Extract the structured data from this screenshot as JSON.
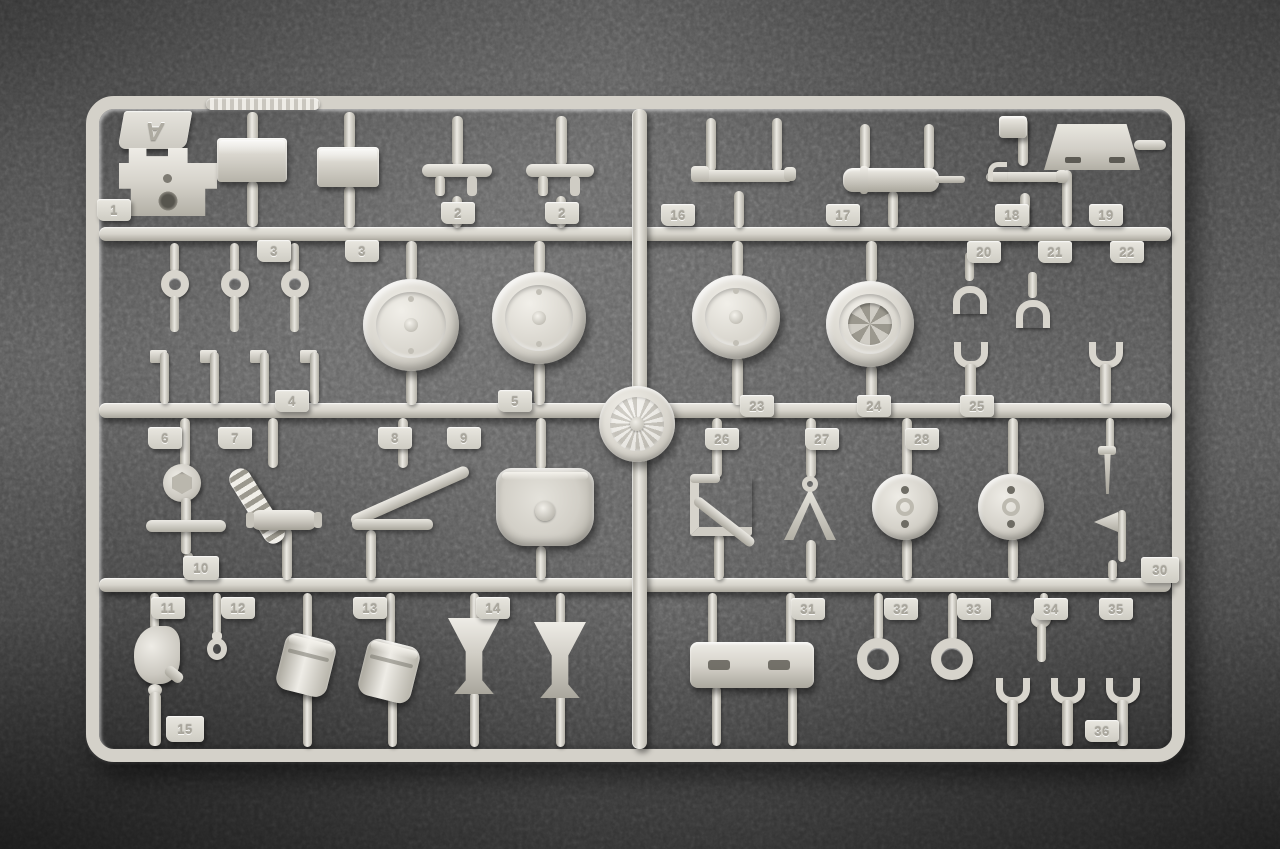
{
  "sprue": {
    "letter": "A",
    "plastic_color": "#d7d4cc",
    "plastic_highlight": "#efede7",
    "plastic_shadow": "#a8a59b"
  },
  "background": {
    "carpet_color": "#5b5b5b",
    "vignette_color": "#2e2e2e"
  },
  "logo": {
    "icon": "embossed-emblem-icon"
  },
  "part_numbers_visible": [
    "1",
    "2",
    "3",
    "4",
    "5",
    "6",
    "7",
    "8",
    "9",
    "10",
    "11",
    "12",
    "13",
    "14",
    "15",
    "16",
    "17",
    "18",
    "19",
    "20",
    "21",
    "22",
    "23",
    "24",
    "25",
    "26",
    "27",
    "28",
    "30",
    "31",
    "32",
    "33",
    "34",
    "35",
    "36"
  ],
  "parts": [
    {
      "t": "pin",
      "x": 247,
      "y": 112,
      "w": 11,
      "h": 30
    },
    {
      "t": "pin",
      "x": 247,
      "y": 181,
      "w": 11,
      "h": 46
    },
    {
      "t": "pin",
      "x": 344,
      "y": 112,
      "w": 11,
      "h": 38
    },
    {
      "t": "pin",
      "x": 344,
      "y": 186,
      "w": 11,
      "h": 42
    },
    {
      "t": "pin",
      "x": 452,
      "y": 116,
      "w": 11,
      "h": 50
    },
    {
      "t": "pin",
      "x": 556,
      "y": 116,
      "w": 11,
      "h": 50
    },
    {
      "t": "pin",
      "x": 452,
      "y": 196,
      "w": 10,
      "h": 32
    },
    {
      "t": "pin",
      "x": 556,
      "y": 196,
      "w": 10,
      "h": 32
    },
    {
      "t": "pin",
      "x": 706,
      "y": 118,
      "w": 10,
      "h": 54
    },
    {
      "t": "pin",
      "x": 772,
      "y": 118,
      "w": 10,
      "h": 54
    },
    {
      "t": "pin",
      "x": 734,
      "y": 191,
      "w": 10,
      "h": 37
    },
    {
      "t": "pin",
      "x": 860,
      "y": 124,
      "w": 10,
      "h": 46
    },
    {
      "t": "pin",
      "x": 924,
      "y": 124,
      "w": 10,
      "h": 46
    },
    {
      "t": "pin",
      "x": 888,
      "y": 191,
      "w": 10,
      "h": 37
    },
    {
      "t": "pin",
      "x": 1018,
      "y": 118,
      "w": 10,
      "h": 48
    },
    {
      "t": "pin",
      "x": 1020,
      "y": 193,
      "w": 10,
      "h": 35
    },
    {
      "t": "pin",
      "x": 1062,
      "y": 170,
      "w": 10,
      "h": 57
    },
    {
      "t": "pinh",
      "x": 1134,
      "y": 140,
      "w": 32,
      "h": 10
    },
    {
      "t": "pin",
      "x": 170,
      "y": 243,
      "w": 9,
      "h": 30
    },
    {
      "t": "pin",
      "x": 230,
      "y": 243,
      "w": 9,
      "h": 30
    },
    {
      "t": "pin",
      "x": 290,
      "y": 243,
      "w": 9,
      "h": 30
    },
    {
      "t": "pin",
      "x": 406,
      "y": 241,
      "w": 11,
      "h": 40
    },
    {
      "t": "pin",
      "x": 406,
      "y": 369,
      "w": 11,
      "h": 36
    },
    {
      "t": "pin",
      "x": 534,
      "y": 241,
      "w": 11,
      "h": 33
    },
    {
      "t": "pin",
      "x": 534,
      "y": 362,
      "w": 11,
      "h": 43
    },
    {
      "t": "pin",
      "x": 732,
      "y": 241,
      "w": 11,
      "h": 36
    },
    {
      "t": "pin",
      "x": 732,
      "y": 357,
      "w": 11,
      "h": 48
    },
    {
      "t": "pin",
      "x": 866,
      "y": 241,
      "w": 11,
      "h": 42
    },
    {
      "t": "pin",
      "x": 866,
      "y": 365,
      "w": 11,
      "h": 40
    },
    {
      "t": "pin",
      "x": 968,
      "y": 241,
      "w": 9,
      "h": 14
    },
    {
      "t": "pin",
      "x": 1106,
      "y": 418,
      "w": 8,
      "h": 32
    },
    {
      "t": "pin",
      "x": 180,
      "y": 418,
      "w": 10,
      "h": 50
    },
    {
      "t": "pin",
      "x": 184,
      "y": 552,
      "w": 9,
      "h": 28
    },
    {
      "t": "pin",
      "x": 268,
      "y": 418,
      "w": 10,
      "h": 50
    },
    {
      "t": "pin",
      "x": 282,
      "y": 528,
      "w": 10,
      "h": 52
    },
    {
      "t": "pin",
      "x": 398,
      "y": 418,
      "w": 10,
      "h": 50
    },
    {
      "t": "pin",
      "x": 366,
      "y": 530,
      "w": 10,
      "h": 50
    },
    {
      "t": "pin",
      "x": 536,
      "y": 418,
      "w": 10,
      "h": 52
    },
    {
      "t": "pin",
      "x": 536,
      "y": 546,
      "w": 10,
      "h": 34
    },
    {
      "t": "pin",
      "x": 712,
      "y": 418,
      "w": 10,
      "h": 60
    },
    {
      "t": "pin",
      "x": 714,
      "y": 534,
      "w": 10,
      "h": 46
    },
    {
      "t": "pin",
      "x": 806,
      "y": 418,
      "w": 10,
      "h": 60
    },
    {
      "t": "pin",
      "x": 806,
      "y": 540,
      "w": 10,
      "h": 40
    },
    {
      "t": "pin",
      "x": 902,
      "y": 418,
      "w": 10,
      "h": 58
    },
    {
      "t": "pin",
      "x": 902,
      "y": 538,
      "w": 10,
      "h": 42
    },
    {
      "t": "pin",
      "x": 1008,
      "y": 418,
      "w": 10,
      "h": 58
    },
    {
      "t": "pin",
      "x": 1008,
      "y": 538,
      "w": 10,
      "h": 42
    },
    {
      "t": "pin",
      "x": 1108,
      "y": 560,
      "w": 9,
      "h": 20
    },
    {
      "t": "pin",
      "x": 150,
      "y": 593,
      "w": 9,
      "h": 37
    },
    {
      "t": "pin",
      "x": 213,
      "y": 593,
      "w": 8,
      "h": 42
    },
    {
      "t": "pin",
      "x": 303,
      "y": 593,
      "w": 9,
      "h": 46
    },
    {
      "t": "pin",
      "x": 386,
      "y": 593,
      "w": 9,
      "h": 52
    },
    {
      "t": "pin",
      "x": 303,
      "y": 692,
      "w": 9,
      "h": 55
    },
    {
      "t": "pin",
      "x": 388,
      "y": 698,
      "w": 9,
      "h": 49
    },
    {
      "t": "pin",
      "x": 470,
      "y": 593,
      "w": 9,
      "h": 29
    },
    {
      "t": "pin",
      "x": 556,
      "y": 593,
      "w": 9,
      "h": 32
    },
    {
      "t": "pin",
      "x": 470,
      "y": 692,
      "w": 9,
      "h": 55
    },
    {
      "t": "pin",
      "x": 556,
      "y": 694,
      "w": 9,
      "h": 53
    },
    {
      "t": "pin",
      "x": 708,
      "y": 593,
      "w": 9,
      "h": 52
    },
    {
      "t": "pin",
      "x": 786,
      "y": 593,
      "w": 9,
      "h": 52
    },
    {
      "t": "pin",
      "x": 712,
      "y": 686,
      "w": 9,
      "h": 60
    },
    {
      "t": "pin",
      "x": 788,
      "y": 686,
      "w": 9,
      "h": 60
    },
    {
      "t": "pin",
      "x": 874,
      "y": 593,
      "w": 9,
      "h": 48
    },
    {
      "t": "pin",
      "x": 948,
      "y": 593,
      "w": 9,
      "h": 48
    },
    {
      "t": "pin",
      "x": 1040,
      "y": 593,
      "w": 8,
      "h": 21
    },
    {
      "t": "bracket",
      "x": 119,
      "y": 148,
      "w": 98,
      "h": 68,
      "n": "mount-bracket-part"
    },
    {
      "t": "boxp",
      "x": 217,
      "y": 138,
      "w": 70,
      "h": 44,
      "n": "stowage-box-part"
    },
    {
      "t": "boxp",
      "x": 317,
      "y": 147,
      "w": 62,
      "h": 40,
      "n": "stowage-box-part"
    },
    {
      "t": "tbar",
      "x": 422,
      "y": 164,
      "w": 70,
      "h": 36,
      "n": "t-rod-part"
    },
    {
      "t": "tbar",
      "x": 526,
      "y": 164,
      "w": 68,
      "h": 36,
      "n": "t-rod-part"
    },
    {
      "t": "rodf",
      "x": 695,
      "y": 170,
      "w": 98,
      "h": 12,
      "n": "linkage-rod-part"
    },
    {
      "t": "cylh",
      "x": 843,
      "y": 168,
      "w": 96,
      "h": 24,
      "n": "cylinder-rod-part"
    },
    {
      "t": "rodh",
      "x": 986,
      "y": 172,
      "w": 80,
      "h": 10,
      "n": "hooked-rod-part"
    },
    {
      "t": "blk",
      "x": 999,
      "y": 116,
      "w": 28,
      "h": 22,
      "n": "small-block-part"
    },
    {
      "t": "plate",
      "x": 1044,
      "y": 124,
      "w": 96,
      "h": 46,
      "n": "hull-plate-part"
    },
    {
      "t": "ringpin",
      "x": 156,
      "y": 270,
      "w": 38,
      "h": 62,
      "n": "ring-pin-part"
    },
    {
      "t": "ringpin",
      "x": 216,
      "y": 270,
      "w": 38,
      "h": 62,
      "n": "ring-pin-part"
    },
    {
      "t": "ringpin",
      "x": 276,
      "y": 270,
      "w": 38,
      "h": 62,
      "n": "ring-pin-part"
    },
    {
      "t": "wheel",
      "x": 363,
      "y": 279,
      "w": 96,
      "h": 92,
      "n": "road-wheel-part"
    },
    {
      "t": "wheel",
      "x": 492,
      "y": 272,
      "w": 94,
      "h": 92,
      "n": "road-wheel-part"
    },
    {
      "t": "pinflag",
      "x": 150,
      "y": 350,
      "w": 28,
      "h": 54,
      "n": "flanged-pin-part"
    },
    {
      "t": "pinflag",
      "x": 200,
      "y": 350,
      "w": 28,
      "h": 54,
      "n": "flanged-pin-part"
    },
    {
      "t": "pinflag",
      "x": 250,
      "y": 350,
      "w": 28,
      "h": 54,
      "n": "flanged-pin-part"
    },
    {
      "t": "pinflag",
      "x": 300,
      "y": 350,
      "w": 28,
      "h": 54,
      "n": "flanged-pin-part"
    },
    {
      "t": "wheel",
      "x": 692,
      "y": 275,
      "w": 88,
      "h": 84,
      "n": "road-wheel-part"
    },
    {
      "t": "wheelhub",
      "x": 826,
      "y": 281,
      "w": 88,
      "h": 86,
      "n": "hub-wheel-part"
    },
    {
      "t": "forky",
      "x": 945,
      "y": 252,
      "w": 50,
      "h": 62,
      "n": "clevis-fork-part"
    },
    {
      "t": "forky",
      "x": 1009,
      "y": 272,
      "w": 48,
      "h": 56,
      "n": "clevis-fork-part"
    },
    {
      "t": "forku",
      "x": 946,
      "y": 342,
      "w": 50,
      "h": 62,
      "n": "tow-fork-part"
    },
    {
      "t": "forku",
      "x": 1081,
      "y": 342,
      "w": 50,
      "h": 62,
      "n": "tow-fork-part"
    },
    {
      "t": "disc6",
      "x": 163,
      "y": 464,
      "w": 38,
      "h": 38,
      "n": "hex-disc-part"
    },
    {
      "t": "crossp",
      "x": 146,
      "y": 498,
      "w": 80,
      "h": 56,
      "n": "cross-lever-part"
    },
    {
      "t": "spring",
      "x": 246,
      "y": 464,
      "w": 22,
      "h": 84,
      "r": -32,
      "n": "coil-spring-part"
    },
    {
      "t": "cylsm",
      "x": 251,
      "y": 510,
      "w": 66,
      "h": 20,
      "n": "small-cylinder-part"
    },
    {
      "t": "trif",
      "x": 352,
      "y": 464,
      "w": 116,
      "h": 66,
      "n": "triangular-brace-part"
    },
    {
      "t": "shell",
      "x": 496,
      "y": 468,
      "w": 98,
      "h": 78,
      "n": "shell-dome-part"
    },
    {
      "t": "zbr",
      "x": 690,
      "y": 476,
      "w": 62,
      "h": 60,
      "n": "z-bracket-part"
    },
    {
      "t": "tripod",
      "x": 784,
      "y": 476,
      "w": 52,
      "h": 64,
      "n": "tripod-mount-part"
    },
    {
      "t": "discm",
      "x": 872,
      "y": 474,
      "w": 66,
      "h": 66,
      "n": "holed-disc-part"
    },
    {
      "t": "discm",
      "x": 978,
      "y": 474,
      "w": 66,
      "h": 66,
      "n": "holed-disc-part"
    },
    {
      "t": "screw",
      "x": 1092,
      "y": 446,
      "w": 30,
      "h": 48,
      "n": "screw-part"
    },
    {
      "t": "flagp",
      "x": 1094,
      "y": 510,
      "w": 38,
      "h": 52,
      "n": "flag-bracket-part"
    },
    {
      "t": "clampp",
      "x": 134,
      "y": 626,
      "w": 46,
      "h": 58,
      "n": "clamp-part"
    },
    {
      "t": "hookp",
      "x": 203,
      "y": 632,
      "w": 28,
      "h": 46,
      "n": "eyelet-hook-part"
    },
    {
      "t": "drum",
      "x": 280,
      "y": 636,
      "w": 52,
      "h": 58,
      "r": 14,
      "n": "drum-part"
    },
    {
      "t": "drum",
      "x": 362,
      "y": 642,
      "w": 54,
      "h": 58,
      "r": 14,
      "n": "drum-part"
    },
    {
      "t": "funnel",
      "x": 448,
      "y": 618,
      "w": 52,
      "h": 76,
      "n": "funnel-part"
    },
    {
      "t": "funnel",
      "x": 534,
      "y": 622,
      "w": 52,
      "h": 76,
      "n": "funnel-part"
    },
    {
      "t": "nozzle",
      "x": 143,
      "y": 684,
      "w": 24,
      "h": 62,
      "n": "nozzle-part"
    },
    {
      "t": "rail",
      "x": 690,
      "y": 642,
      "w": 124,
      "h": 46,
      "n": "rail-part"
    },
    {
      "t": "ringp",
      "x": 857,
      "y": 638,
      "w": 42,
      "h": 42,
      "n": "ring-part"
    },
    {
      "t": "ringp",
      "x": 931,
      "y": 638,
      "w": 42,
      "h": 42,
      "n": "ring-part"
    },
    {
      "t": "boltp",
      "x": 1023,
      "y": 610,
      "w": 36,
      "h": 52,
      "n": "bolt-part"
    },
    {
      "t": "forku",
      "x": 989,
      "y": 678,
      "w": 48,
      "h": 68,
      "n": "tow-fork-part"
    },
    {
      "t": "forku",
      "x": 1044,
      "y": 678,
      "w": 48,
      "h": 68,
      "n": "tow-fork-part"
    },
    {
      "t": "forku",
      "x": 1099,
      "y": 678,
      "w": 48,
      "h": 68,
      "n": "tow-fork-part"
    },
    {
      "t": "tab",
      "x": 97,
      "y": 199,
      "label": "1"
    },
    {
      "t": "tab",
      "x": 441,
      "y": 202,
      "label": "2"
    },
    {
      "t": "tab",
      "x": 545,
      "y": 202,
      "label": "2"
    },
    {
      "t": "tab",
      "x": 257,
      "y": 240,
      "label": "3"
    },
    {
      "t": "tab",
      "x": 345,
      "y": 240,
      "label": "3"
    },
    {
      "t": "tab",
      "x": 275,
      "y": 390,
      "label": "4"
    },
    {
      "t": "tab",
      "x": 498,
      "y": 390,
      "label": "5"
    },
    {
      "t": "tab",
      "x": 148,
      "y": 427,
      "label": "6"
    },
    {
      "t": "tab",
      "x": 218,
      "y": 427,
      "label": "7"
    },
    {
      "t": "tab",
      "x": 378,
      "y": 427,
      "label": "8"
    },
    {
      "t": "tab",
      "x": 447,
      "y": 427,
      "label": "9"
    },
    {
      "t": "tab",
      "x": 183,
      "y": 556,
      "w": 36,
      "h": 24,
      "label": "10"
    },
    {
      "t": "tab",
      "x": 151,
      "y": 597,
      "label": "11"
    },
    {
      "t": "tab",
      "x": 221,
      "y": 597,
      "label": "12"
    },
    {
      "t": "tab",
      "x": 353,
      "y": 597,
      "label": "13"
    },
    {
      "t": "tab",
      "x": 476,
      "y": 597,
      "label": "14"
    },
    {
      "t": "tab",
      "x": 166,
      "y": 716,
      "w": 38,
      "h": 26,
      "label": "15"
    },
    {
      "t": "tab",
      "x": 661,
      "y": 204,
      "label": "16"
    },
    {
      "t": "tab",
      "x": 826,
      "y": 204,
      "label": "17"
    },
    {
      "t": "tab",
      "x": 995,
      "y": 204,
      "label": "18"
    },
    {
      "t": "tab",
      "x": 1089,
      "y": 204,
      "label": "19"
    },
    {
      "t": "tab",
      "x": 967,
      "y": 241,
      "label": "20"
    },
    {
      "t": "tab",
      "x": 1038,
      "y": 241,
      "label": "21"
    },
    {
      "t": "tab",
      "x": 1110,
      "y": 241,
      "label": "22"
    },
    {
      "t": "tab",
      "x": 740,
      "y": 395,
      "label": "23"
    },
    {
      "t": "tab",
      "x": 857,
      "y": 395,
      "label": "24"
    },
    {
      "t": "tab",
      "x": 960,
      "y": 395,
      "label": "25"
    },
    {
      "t": "tab",
      "x": 705,
      "y": 428,
      "label": "26"
    },
    {
      "t": "tab",
      "x": 805,
      "y": 428,
      "label": "27"
    },
    {
      "t": "tab",
      "x": 905,
      "y": 428,
      "label": "28"
    },
    {
      "t": "tab",
      "x": 1141,
      "y": 557,
      "w": 38,
      "h": 26,
      "label": "30"
    },
    {
      "t": "tab",
      "x": 791,
      "y": 598,
      "label": "31"
    },
    {
      "t": "tab",
      "x": 884,
      "y": 598,
      "label": "32"
    },
    {
      "t": "tab",
      "x": 957,
      "y": 598,
      "label": "33"
    },
    {
      "t": "tab",
      "x": 1034,
      "y": 598,
      "label": "34"
    },
    {
      "t": "tab",
      "x": 1099,
      "y": 598,
      "label": "35"
    },
    {
      "t": "tab",
      "x": 1085,
      "y": 720,
      "label": "36"
    }
  ]
}
